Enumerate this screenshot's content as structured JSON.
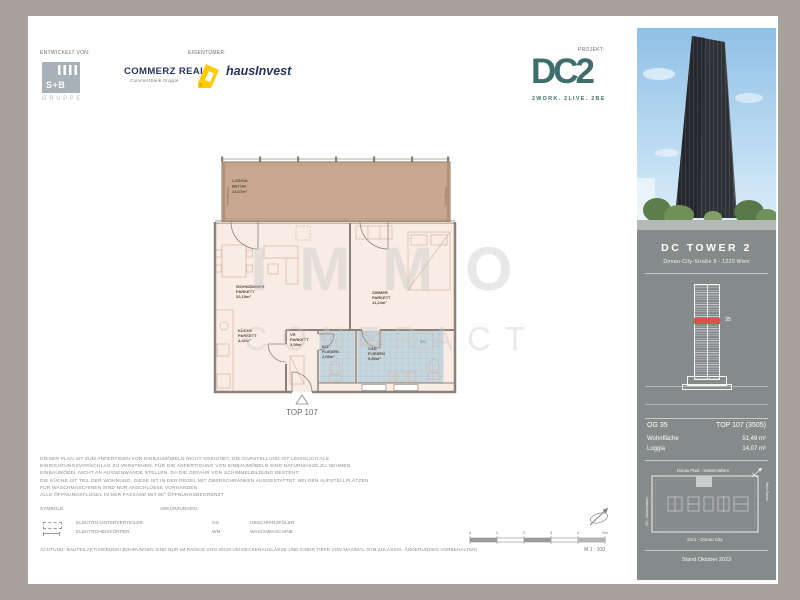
{
  "header": {
    "developed_label": "ENTWICKELT VON:",
    "owner_label": "EIGENTÜMER:",
    "project_label": "PROJEKT:",
    "sb": {
      "text": "S+B",
      "sub": "GRUPPE"
    },
    "commerz": {
      "name": "COMMERZ REAL",
      "sub": "Commerzbank Gruppe"
    },
    "hausinvest": "hausInvest",
    "dc2": {
      "logo": "DC2",
      "tagline": "2WORK. 2LIVE. 2BE"
    }
  },
  "watermark": {
    "line1": "IMMO",
    "line2": "CONTRACT"
  },
  "floorplan": {
    "rooms": {
      "loggia": {
        "name": "LOGGIA",
        "finish": "BETON",
        "area": "14,07m²"
      },
      "wohnzimmer": {
        "name": "WOHNZIMMER",
        "finish": "PARKETT",
        "area": "22,15m²"
      },
      "kueche": {
        "name": "KÜCHE",
        "finish": "PARKETT",
        "area": "4,43m²"
      },
      "vorraum": {
        "name": "VR",
        "finish": "PARKETT",
        "area": "3,08m²"
      },
      "wc": {
        "name": "WC",
        "finish": "FLIESEN",
        "area": "2,05m²"
      },
      "bad": {
        "name": "BAD",
        "finish": "FLIESEN",
        "area": "5,89m²"
      },
      "zimmer": {
        "name": "ZIMMER",
        "finish": "PARKETT",
        "area": "11,24m²"
      }
    },
    "wm_label": "WM",
    "unit_label": "TOP 107",
    "glazing_label": "Fixverglasung"
  },
  "sidebar": {
    "building_name": "DC TOWER 2",
    "address": "Donau-City-Straße 9 - 1220 Wien",
    "elevation_floor": "35",
    "info": {
      "floor": "OG 35",
      "unit": "TOP 107 (3505)",
      "area_label": "Wohnfläche",
      "area_value": "51,49 m²",
      "loggia_label": "Loggia",
      "loggia_value": "14,07 m²"
    },
    "siteplan": {
      "top": "Donau Platz - Kaisermühlen",
      "bottom": "DC1 - Donau City",
      "left": "VIC - Kaiserwasser",
      "right": "Neue Donau"
    },
    "stand": "Stand Oktober 2023"
  },
  "footer": {
    "disclaimer": [
      "DIESER PLAN IST ZUM ANFERTIGEN VON EINBAUMÖBELN NICHT GEEIGNET, DIE DARSTELLUNG IST LEDIGLICH ALS",
      "EINRICHTUNGSVORSCHLAG ZU VERSTEHEN. FÜR DIE ANFERTIGUNG VON EINBAUMÖBELN SIND NATURMASSE ZU NEHMEN.",
      "EINBAUMÖBEL NICHT AN AUSSENWÄNDE STELLEN, DA DIE GEFAHR VON SCHIMMELBILDUNG BESTEHT.",
      "DIE KÜCHE IST TEIL DER WOHNUNG, DIESE IST IN DER REGEL MIT OBERSCHRÄNKEN AUSGESTATTET. BEI DEN AUFSTELLPLÄTZEN",
      "FÜR WASCHMASCHINEN SIND NUR ANSCHLÜSSE VORHANDEN.",
      "ALLE ÖFFNUNGSFLÜGEL IN DER FASSADE MIT 90° ÖFFNUNGSBEGRENZT."
    ],
    "symbole_label": "SYMBOLE:",
    "abk_label": "ABKÜRZUNGEN:",
    "symbols": [
      {
        "label": "ELEKTRO-UNTERVERTEILER"
      },
      {
        "label": "ELEKTROHEIZKÖRPER"
      }
    ],
    "abbreviations": [
      {
        "abbr": "GS",
        "label": "GESCHIRRSPÜLER"
      },
      {
        "abbr": "WM",
        "label": "WASCHMASCHINE"
      }
    ],
    "achtung": "ACHTUNG: BAUTEILAKTIVIERUNG! BOHRUNGEN SIND NUR IM RADIUS VON 30CM UM DECKENAUSLÄSSE UND EINER TIEFE VON MAXIMAL 3CM ZULÄSSIG. ÄNDERUNGEN VORBEHALTEN!",
    "scale": {
      "ticks": [
        "0",
        "1",
        "2",
        "3",
        "4",
        "5m"
      ],
      "label": "M 1 : 100"
    }
  },
  "colors": {
    "frame": "#a6a19a",
    "teal": "#3e6f6c",
    "navy": "#24355c",
    "yellow": "#ffcc00",
    "tan": "#c9a88f",
    "cream": "#f9ece4",
    "tile": "#c6d6de",
    "tileline": "#a3bcc8",
    "wall": "#8b8178",
    "furn": "#d8b6a4",
    "panel": "#858b8a",
    "red": "#d95348"
  }
}
